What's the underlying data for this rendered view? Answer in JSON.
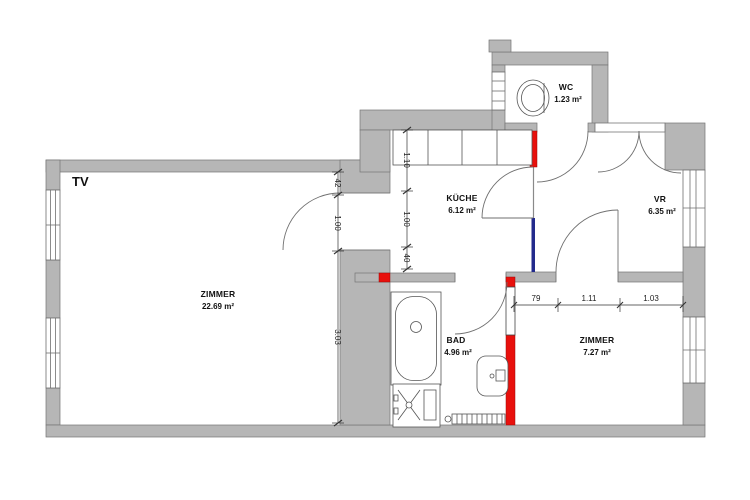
{
  "title": "TV",
  "rooms": {
    "zimmer1": {
      "name": "ZIMMER",
      "area": "22.69 m²"
    },
    "kueche": {
      "name": "KÜCHE",
      "area": "6.12 m²"
    },
    "vr": {
      "name": "VR",
      "area": "6.35 m²"
    },
    "wc": {
      "name": "WC",
      "area": "1.23 m²"
    },
    "bad": {
      "name": "BAD",
      "area": "4.96 m²"
    },
    "zimmer2": {
      "name": "ZIMMER",
      "area": "7.27 m²"
    }
  },
  "dimensions": {
    "zimmer1_right": {
      "d1": "42",
      "d2": "1.00",
      "d3": "3.03"
    },
    "kueche_left": {
      "d1": "1.10",
      "d2": "1.00",
      "d3": "40"
    },
    "zimmer2_top": {
      "d1": "79",
      "d2": "1.11",
      "d3": "1.03"
    }
  },
  "colors": {
    "wall_fill": "#b6b6b6",
    "wall_outline": "#757575",
    "new_wall_red": "#e8100c",
    "marked_wall_blue": "#232a8c"
  }
}
